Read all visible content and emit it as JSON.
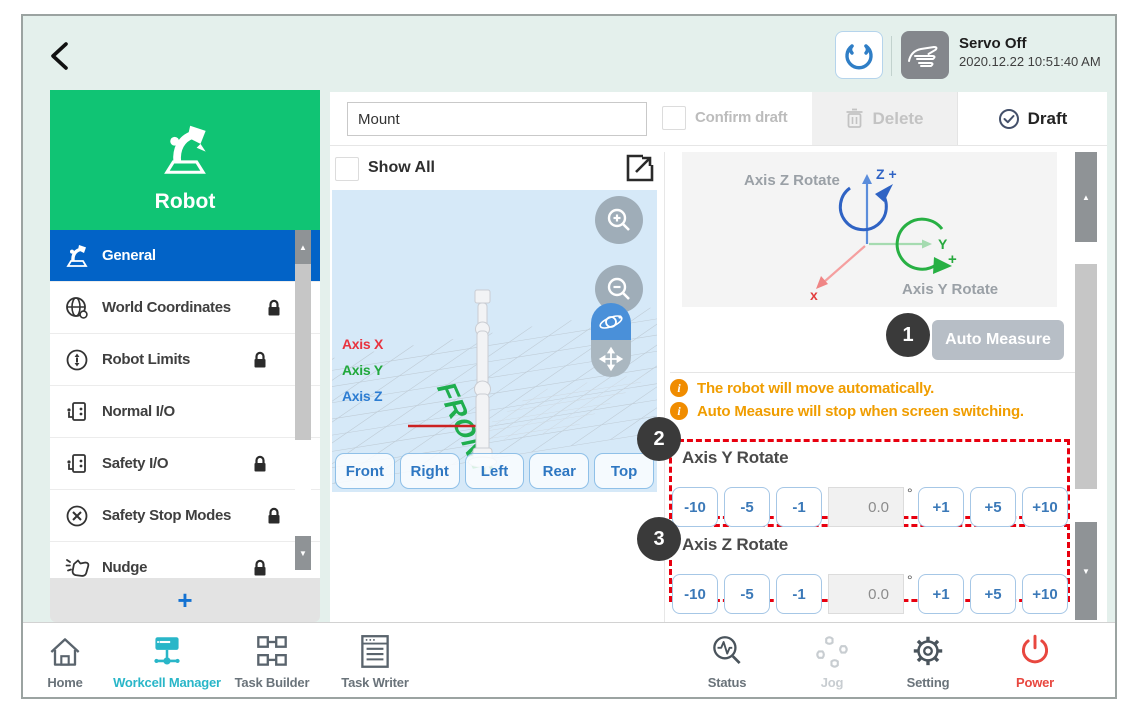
{
  "header": {
    "servo_status": "Servo Off",
    "timestamp": "2020.12.22 10:51:40 AM"
  },
  "sidebar": {
    "title": "Robot",
    "items": [
      {
        "label": "General",
        "selected": true,
        "locked": false
      },
      {
        "label": "World Coordinates",
        "selected": false,
        "locked": true
      },
      {
        "label": "Robot Limits",
        "selected": false,
        "locked": true
      },
      {
        "label": "Normal I/O",
        "selected": false,
        "locked": false
      },
      {
        "label": "Safety I/O",
        "selected": false,
        "locked": true
      },
      {
        "label": "Safety Stop Modes",
        "selected": false,
        "locked": true
      },
      {
        "label": "Nudge",
        "selected": false,
        "locked": true
      }
    ],
    "add_button_label": "+"
  },
  "toolbar": {
    "name_field_value": "Mount",
    "confirm_draft_label": "Confirm draft",
    "delete_label": "Delete",
    "draft_label": "Draft"
  },
  "viewer": {
    "show_all_label": "Show All",
    "axis_x_label": "Axis X",
    "axis_y_label": "Axis Y",
    "axis_z_label": "Axis Z",
    "floor_label": "FRONT",
    "view_buttons": [
      "Front",
      "Right",
      "Left",
      "Rear",
      "Top"
    ]
  },
  "measure_panel": {
    "diagram": {
      "axis_z_rotate_label": "Axis Z Rotate",
      "axis_y_rotate_label": "Axis Y Rotate",
      "z_axis_label": "Z +",
      "y_axis_label": "Y",
      "y_plus_label": "+",
      "x_axis_label": "x"
    },
    "step1_badge": "1",
    "auto_measure_label": "Auto Measure",
    "notices": [
      "The robot will move automatically.",
      "Auto Measure will stop when screen switching."
    ],
    "sections": [
      {
        "badge": "2",
        "title": "Axis Y Rotate",
        "minus_buttons": [
          "-10",
          "-5",
          "-1"
        ],
        "value": "0.0",
        "unit": "°",
        "plus_buttons": [
          "+1",
          "+5",
          "+10"
        ]
      },
      {
        "badge": "3",
        "title": "Axis Z Rotate",
        "minus_buttons": [
          "-10",
          "-5",
          "-1"
        ],
        "value": "0.0",
        "unit": "°",
        "plus_buttons": [
          "+1",
          "+5",
          "+10"
        ]
      }
    ]
  },
  "nav": {
    "items_left": [
      {
        "label": "Home",
        "state": "normal"
      },
      {
        "label": "Workcell Manager",
        "state": "active"
      },
      {
        "label": "Task Builder",
        "state": "normal"
      },
      {
        "label": "Task Writer",
        "state": "normal"
      }
    ],
    "items_right": [
      {
        "label": "Status",
        "state": "normal"
      },
      {
        "label": "Jog",
        "state": "disabled"
      },
      {
        "label": "Setting",
        "state": "normal"
      },
      {
        "label": "Power",
        "state": "power"
      }
    ]
  },
  "scrollbar": {
    "up_glyph": "▲",
    "down_glyph": "▼"
  },
  "colors": {
    "brand_green": "#10c474",
    "selected_blue": "#0263c7",
    "accent_teal": "#29b6c8",
    "warning_orange": "#f09d00",
    "highlight_red": "#e8000f",
    "power_red": "#e8473f",
    "viewer_bg_blue": "#d6e9f8",
    "servo_icon_grey": "#84878c"
  }
}
